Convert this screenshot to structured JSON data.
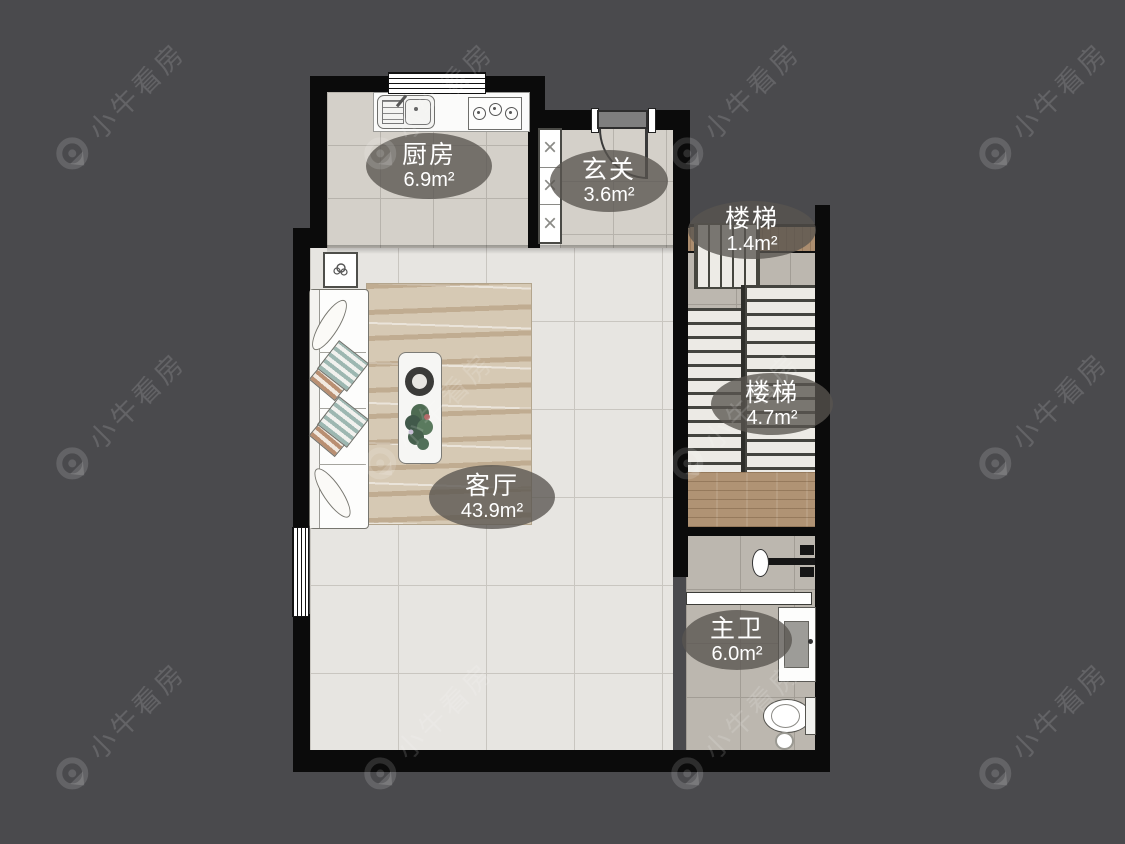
{
  "watermark": {
    "text": "小牛看房",
    "icon": "bull-location-pin"
  },
  "rooms": {
    "kitchen": {
      "name": "厨房",
      "area": "6.9m²"
    },
    "entrance": {
      "name": "玄关",
      "area": "3.6m²"
    },
    "stairs_small": {
      "name": "楼梯",
      "area": "1.4m²"
    },
    "stairs_main": {
      "name": "楼梯",
      "area": "4.7m²"
    },
    "living": {
      "name": "客厅",
      "area": "43.9m²"
    },
    "bathroom": {
      "name": "主卫",
      "area": "6.0m²"
    }
  },
  "colors": {
    "background": "#4a4a4d",
    "wall": "#0b0b0b",
    "living_tile": "#e7e5e1",
    "kitchen_tile": "#d4d0c9",
    "bath_tile": "#bcb7af",
    "wood": "#ab8d6f",
    "label_bubble": "rgba(88,85,80,0.78)",
    "watermark": "rgba(255,255,255,0.14)"
  }
}
